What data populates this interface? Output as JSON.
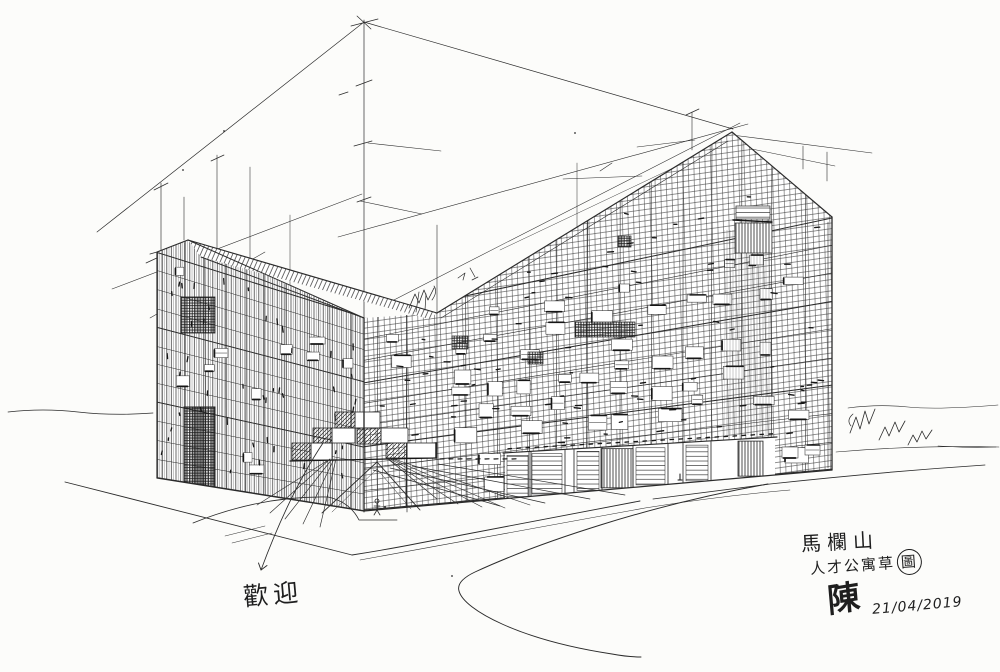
{
  "artwork": {
    "entrance_label": "歡迎",
    "caption": {
      "line1": "馬欄山",
      "line2_text": "人才公寓草",
      "line2_circled": "圖",
      "signature": "陳",
      "date": "21/04/2019"
    }
  },
  "colors": {
    "ink": "#2b2b2b",
    "paper": "#fcfcfa"
  }
}
